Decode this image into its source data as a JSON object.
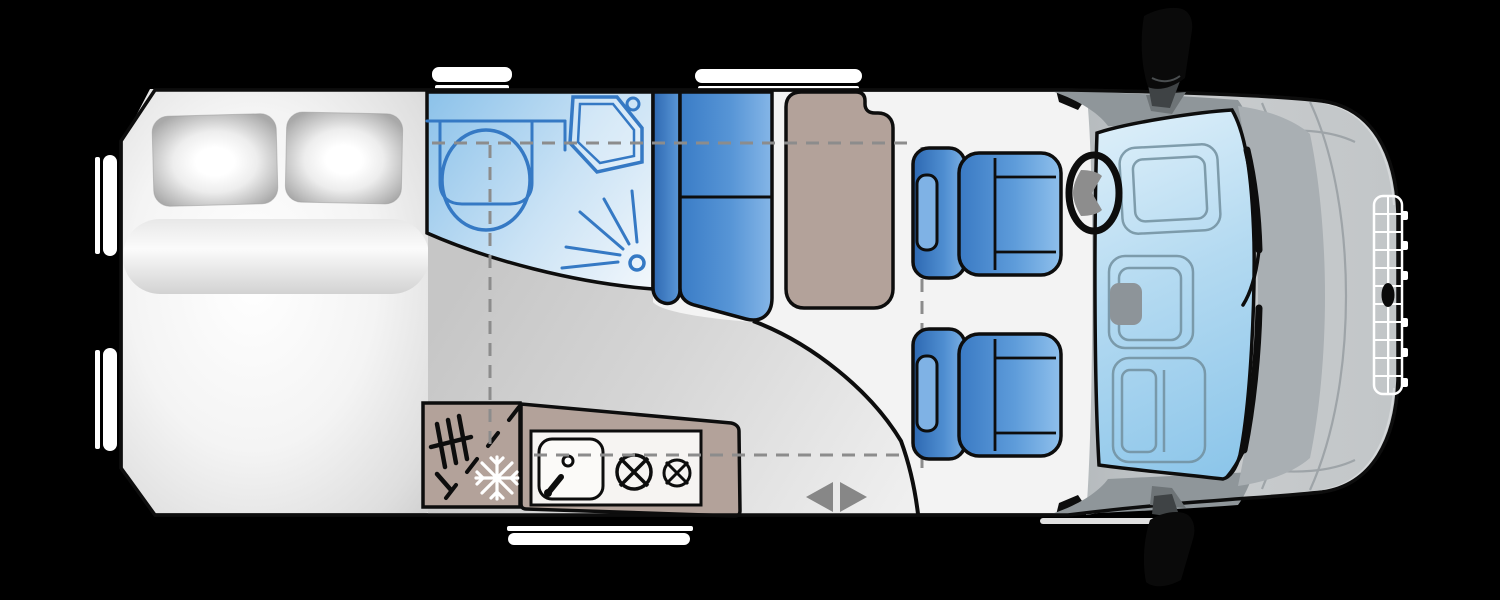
{
  "title": "Motorhome floor plan - top view",
  "vehicle": {
    "type": "semi-integrated motorhome floorplan",
    "orientation": "rear on left, driver cab and bonnet on right",
    "cab_seat_count": 2
  },
  "colors": {
    "background": "#000000",
    "outline": "#0d0d0d",
    "body": "#f3f3f3",
    "floor": "#cccccc",
    "furniture": "#b3a29a",
    "upholstery": "#3b7cc6",
    "bathroom": "#94c7ec",
    "fixture_stroke": "#3579c4",
    "glass": "#a8d4ef",
    "cab_gray": "#c3c7c9",
    "dark_band": "#8f969a",
    "dash_line": "#8c8c8c",
    "arrow": "#878787",
    "window": "#ffffff",
    "panel_white": "#f6f4f2",
    "snowflake": "#ffffff"
  },
  "areas": {
    "bed": {
      "label": "Rear double bed",
      "pillow_count": 2,
      "parts": [
        "mattress",
        "bolster",
        "pillows"
      ]
    },
    "bathroom": {
      "label": "Washroom",
      "features": [
        "toilet",
        "shower tray",
        "shower spray"
      ]
    },
    "dinette": {
      "label": "Dinette",
      "features": [
        "bench seat",
        "table"
      ]
    },
    "kitchen": {
      "label": "Kitchen",
      "features": [
        "fridge",
        "sink with tap",
        "two-burner hob"
      ]
    },
    "entrance": {
      "label": "Entrance door",
      "indicator": "left-right double arrow",
      "swing": "quarter-circle arc"
    },
    "cab": {
      "label": "Driver cab",
      "features": [
        "driver seat",
        "passenger seat",
        "steering wheel",
        "windscreen",
        "side mirrors",
        "headlights",
        "radiator grille"
      ]
    }
  },
  "windows": {
    "top_edge": 2,
    "bottom_edge": 1,
    "rear_left_edge": 2
  }
}
